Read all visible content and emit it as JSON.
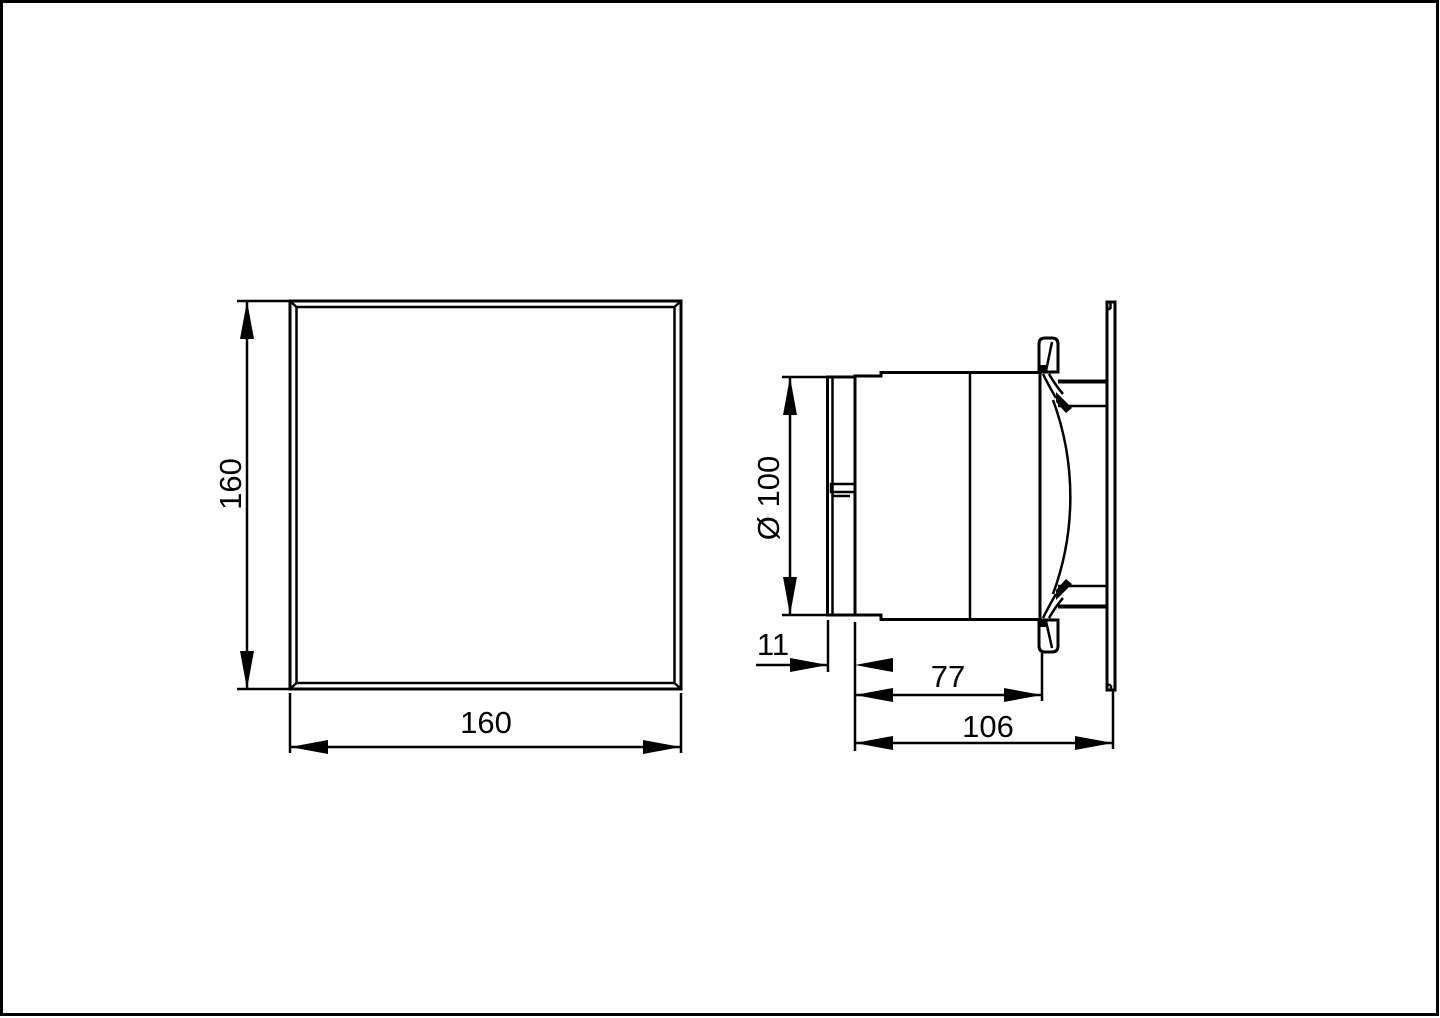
{
  "drawing": {
    "background_color": "#ffffff",
    "line_color": "#000000",
    "views": {
      "front_view": {
        "height_dimension": "160",
        "width_dimension": "160"
      },
      "side_view": {
        "diameter_dimension": "Ø 100",
        "duct_protrusion_dimension": "11",
        "body_depth_dimension": "77",
        "overall_depth_dimension": "106"
      }
    }
  }
}
